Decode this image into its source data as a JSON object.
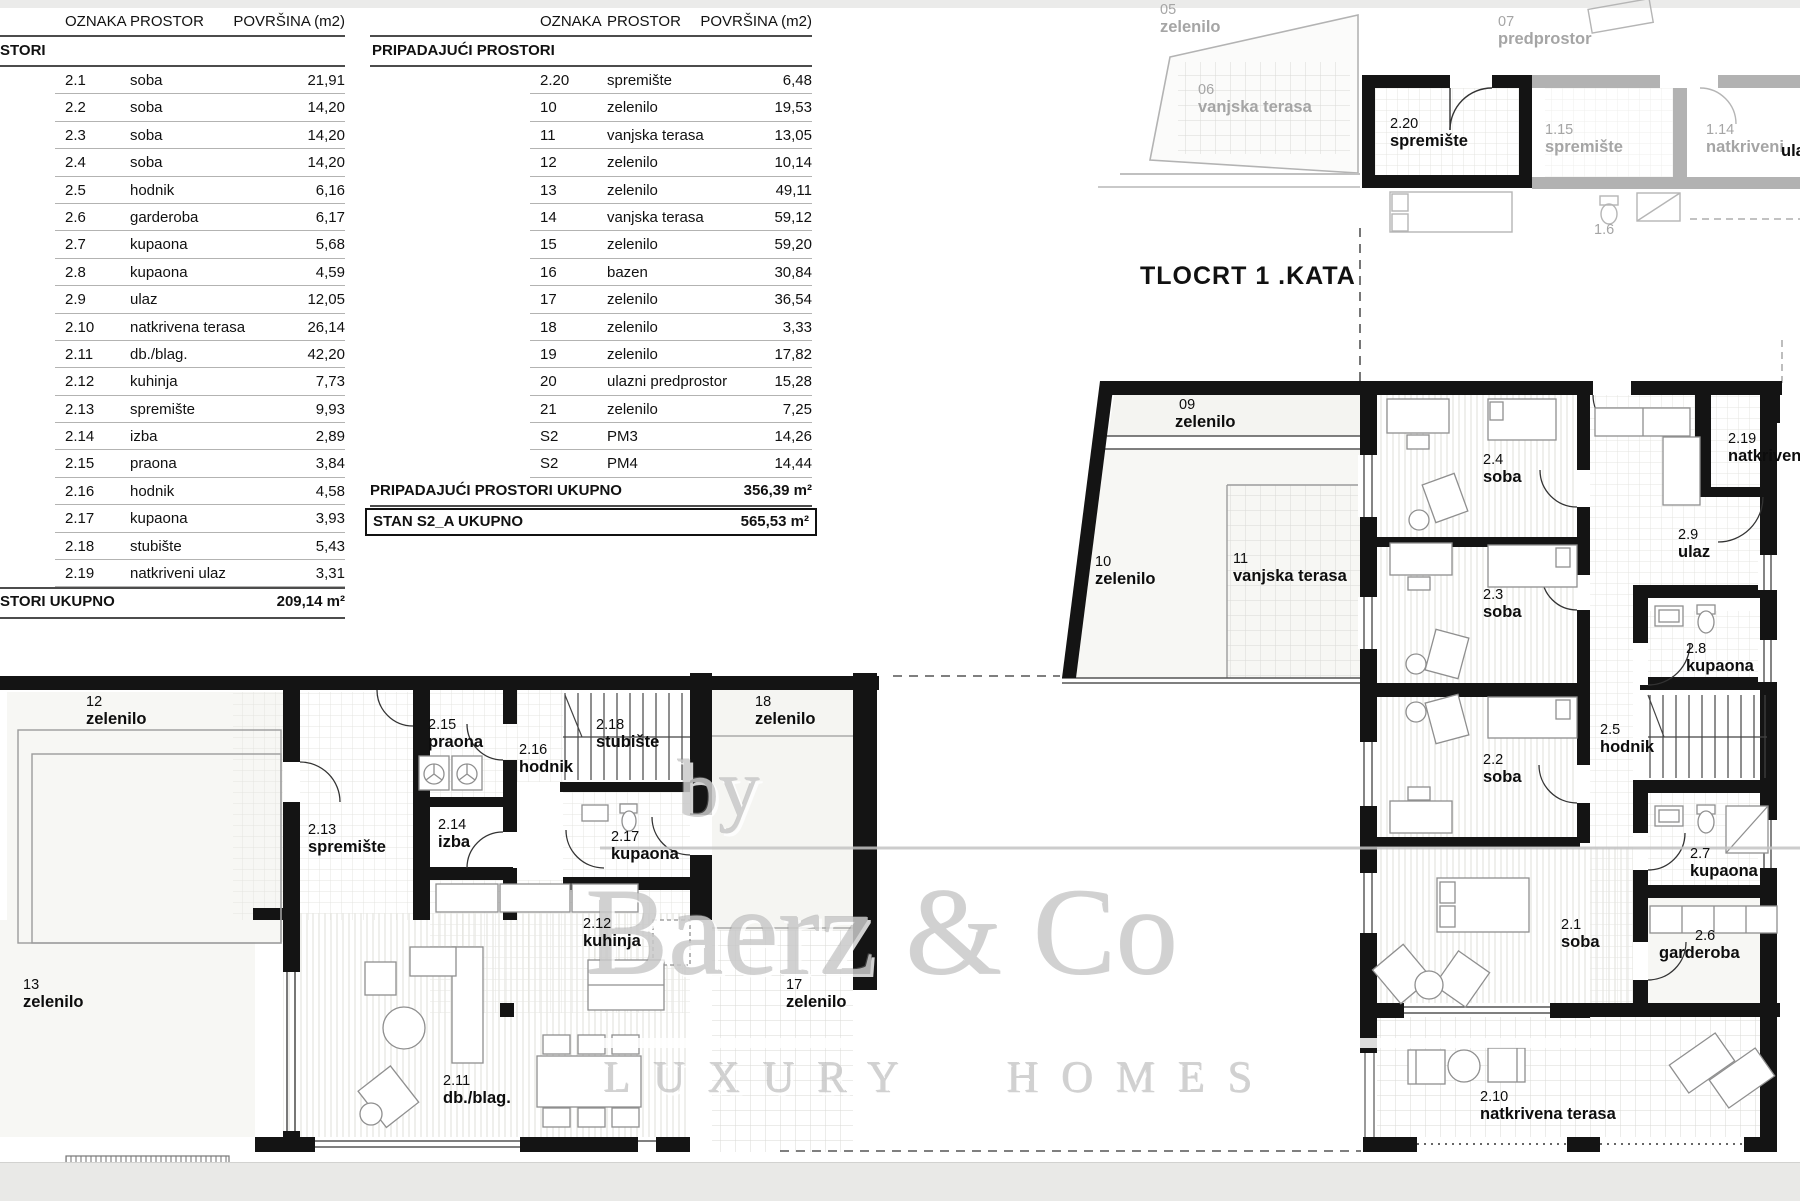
{
  "left_table": {
    "headers": [
      "OZNAKA",
      "PROSTOR",
      "POVRŠINA (m2)"
    ],
    "section": "STORI",
    "rows": [
      {
        "oznaka": "2.1",
        "prostor": "soba",
        "povrsina": "21,91"
      },
      {
        "oznaka": "2.2",
        "prostor": "soba",
        "povrsina": "14,20"
      },
      {
        "oznaka": "2.3",
        "prostor": "soba",
        "povrsina": "14,20"
      },
      {
        "oznaka": "2.4",
        "prostor": "soba",
        "povrsina": "14,20"
      },
      {
        "oznaka": "2.5",
        "prostor": "hodnik",
        "povrsina": "6,16"
      },
      {
        "oznaka": "2.6",
        "prostor": "garderoba",
        "povrsina": "6,17"
      },
      {
        "oznaka": "2.7",
        "prostor": "kupaona",
        "povrsina": "5,68"
      },
      {
        "oznaka": "2.8",
        "prostor": "kupaona",
        "povrsina": "4,59"
      },
      {
        "oznaka": "2.9",
        "prostor": "ulaz",
        "povrsina": "12,05"
      },
      {
        "oznaka": "2.10",
        "prostor": "natkrivena terasa",
        "povrsina": "26,14"
      },
      {
        "oznaka": "2.11",
        "prostor": "db./blag.",
        "povrsina": "42,20"
      },
      {
        "oznaka": "2.12",
        "prostor": "kuhinja",
        "povrsina": "7,73"
      },
      {
        "oznaka": "2.13",
        "prostor": "spremište",
        "povrsina": "9,93"
      },
      {
        "oznaka": "2.14",
        "prostor": "izba",
        "povrsina": "2,89"
      },
      {
        "oznaka": "2.15",
        "prostor": "praona",
        "povrsina": "3,84"
      },
      {
        "oznaka": "2.16",
        "prostor": "hodnik",
        "povrsina": "4,58"
      },
      {
        "oznaka": "2.17",
        "prostor": "kupaona",
        "povrsina": "3,93"
      },
      {
        "oznaka": "2.18",
        "prostor": "stubište",
        "povrsina": "5,43"
      },
      {
        "oznaka": "2.19",
        "prostor": "natkriveni ulaz",
        "povrsina": "3,31"
      }
    ],
    "total": {
      "label": "STORI UKUPNO",
      "value": "209,14 m²"
    }
  },
  "right_table": {
    "headers": [
      "OZNAKA",
      "PROSTOR",
      "POVRŠINA (m2)"
    ],
    "section": "PRIPADAJUĆI PROSTORI",
    "rows": [
      {
        "oznaka": "2.20",
        "prostor": "spremište",
        "povrsina": "6,48"
      },
      {
        "oznaka": "10",
        "prostor": "zelenilo",
        "povrsina": "19,53"
      },
      {
        "oznaka": "11",
        "prostor": "vanjska terasa",
        "povrsina": "13,05"
      },
      {
        "oznaka": "12",
        "prostor": "zelenilo",
        "povrsina": "10,14"
      },
      {
        "oznaka": "13",
        "prostor": "zelenilo",
        "povrsina": "49,11"
      },
      {
        "oznaka": "14",
        "prostor": "vanjska terasa",
        "povrsina": "59,12"
      },
      {
        "oznaka": "15",
        "prostor": "zelenilo",
        "povrsina": "59,20"
      },
      {
        "oznaka": "16",
        "prostor": "bazen",
        "povrsina": "30,84"
      },
      {
        "oznaka": "17",
        "prostor": "zelenilo",
        "povrsina": "36,54"
      },
      {
        "oznaka": "18",
        "prostor": "zelenilo",
        "povrsina": "3,33"
      },
      {
        "oznaka": "19",
        "prostor": "zelenilo",
        "povrsina": "17,82"
      },
      {
        "oznaka": "20",
        "prostor": "ulazni predprostor",
        "povrsina": "15,28"
      },
      {
        "oznaka": "21",
        "prostor": "zelenilo",
        "povrsina": "7,25"
      },
      {
        "oznaka": "S2",
        "prostor": "PM3",
        "povrsina": "14,26"
      },
      {
        "oznaka": "S2",
        "prostor": "PM4",
        "povrsina": "14,44"
      }
    ],
    "subtotal": {
      "label": "PRIPADAJUĆI PROSTORI UKUPNO",
      "value": "356,39 m²"
    },
    "total": {
      "label": "STAN S2_A UKUPNO",
      "value": "565,53 m²"
    }
  },
  "plan": {
    "title": "TLOCRT 1 .KATA",
    "watermark": {
      "by": "by",
      "brand": "Baerz & Co",
      "tagline": "LUXURY HOMES"
    },
    "rooms": {
      "r05": {
        "num": "05",
        "name": "zelenilo"
      },
      "r06": {
        "num": "06",
        "name": "vanjska terasa"
      },
      "r07": {
        "num": "07",
        "name": "predprostor"
      },
      "r115": {
        "num": "1.15",
        "name": "spremište"
      },
      "r114": {
        "num": "1.14",
        "name": "natkriveni"
      },
      "rula": {
        "num": "",
        "name": "ula"
      },
      "r16": {
        "num": "1.6",
        "name": ""
      },
      "r220": {
        "num": "2.20",
        "name": "spremište"
      },
      "r09": {
        "num": "09",
        "name": "zelenilo"
      },
      "r10": {
        "num": "10",
        "name": "zelenilo"
      },
      "r11": {
        "num": "11",
        "name": "vanjska terasa"
      },
      "r24": {
        "num": "2.4",
        "name": "soba"
      },
      "r219": {
        "num": "2.19",
        "name": "natkriven"
      },
      "r29": {
        "num": "2.9",
        "name": "ulaz"
      },
      "r23": {
        "num": "2.3",
        "name": "soba"
      },
      "r28": {
        "num": "2.8",
        "name": "kupaona"
      },
      "r25": {
        "num": "2.5",
        "name": "hodnik"
      },
      "r22": {
        "num": "2.2",
        "name": "soba"
      },
      "r27": {
        "num": "2.7",
        "name": "kupaona"
      },
      "r21": {
        "num": "2.1",
        "name": "soba"
      },
      "r26": {
        "num": "2.6",
        "name": "garderoba"
      },
      "r210": {
        "num": "2.10",
        "name": "natkrivena terasa"
      },
      "r12": {
        "num": "12",
        "name": "zelenilo"
      },
      "r215": {
        "num": "2.15",
        "name": "praona"
      },
      "r216": {
        "num": "2.16",
        "name": "hodnik"
      },
      "r218": {
        "num": "2.18",
        "name": "stubište"
      },
      "r18": {
        "num": "18",
        "name": "zelenilo"
      },
      "r213": {
        "num": "2.13",
        "name": "spremište"
      },
      "r214": {
        "num": "2.14",
        "name": "izba"
      },
      "r217": {
        "num": "2.17",
        "name": "kupaona"
      },
      "r13": {
        "num": "13",
        "name": "zelenilo"
      },
      "r212": {
        "num": "2.12",
        "name": "kuhinja"
      },
      "r17": {
        "num": "17",
        "name": "zelenilo"
      },
      "r211": {
        "num": "2.11",
        "name": "db./blag."
      }
    }
  }
}
